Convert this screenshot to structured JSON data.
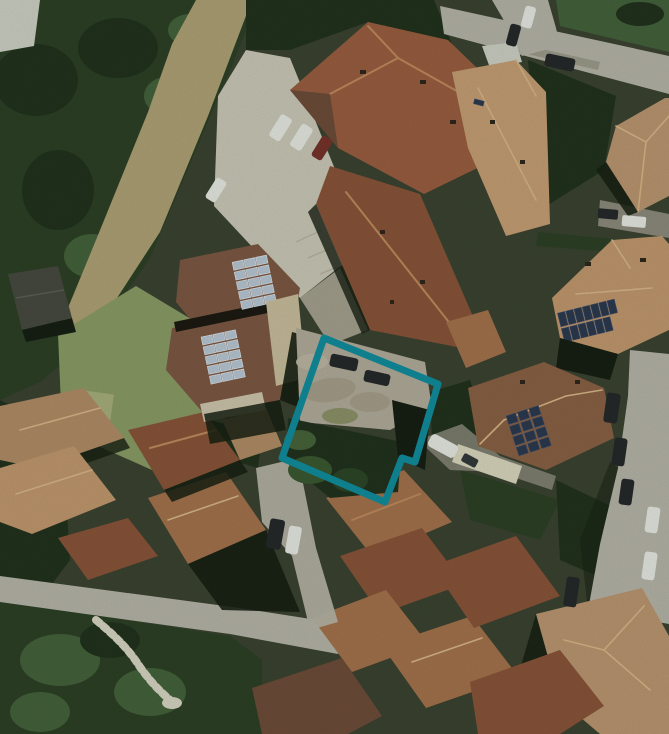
{
  "meta": {
    "view": "satellite-aerial-photograph",
    "description": "Top-down satellite view of a village block with terracotta roofs, gardens, parking areas and a highlighted land parcel",
    "width_px": 669,
    "height_px": 734,
    "no_visible_text": true
  },
  "overlay": {
    "parcel": {
      "name": "highlighted parcel boundary",
      "points": "324,338 438,384 415,462 402,458 385,502 282,458",
      "stroke_width_px": 7,
      "color": "#0f7f8e",
      "shape": "rotated quadrilateral with small step notch on lower-right edge"
    }
  },
  "palette": {
    "base": "#3a4130",
    "tree_dark": "#2c3f24",
    "tree_darker": "#20301c",
    "tree_mid": "#44603a",
    "grass_dry": "#b0a176",
    "grass_lawn": "#8b9b66",
    "lawn_light": "#a8ae7d",
    "pale_patch": "#cfd0c6",
    "paving_light": "#ccc8b8",
    "gravel": "#b3ab9b",
    "road": "#b7b4a9",
    "road_dark": "#8d8a7c",
    "roof_terracotta": "#9a5c40",
    "roof_brown": "#8a5338",
    "roof_brown2": "#7d5743",
    "roof_light_tan": "#c79e74",
    "roof_tan": "#c2976e",
    "roof_salmon": "#bb9570",
    "roof_mid": "#a5714c",
    "roof_pale": "#b28c66",
    "roof_dark": "#6e4a38",
    "ridge": "#c08a5f",
    "ridge_light": "#d9b688",
    "chimney": "#2e241c",
    "shadow": "#161d12",
    "solar_dark": "#2b3750",
    "solar_light": "#b9c7d6",
    "car_white": "#e8e8e4",
    "car_dark": "#24262a",
    "car_red": "#77312a",
    "path_white": "#d9d5c4",
    "terrace": "#cabc9c",
    "parcel_teal": "#0f7f8e"
  },
  "scene": {
    "features": [
      {
        "name": "parcel-boundary-overlay",
        "label": "teal outlined land parcel around a gravel yard with trees"
      },
      {
        "name": "courtyard-gravel",
        "label": "gravel courtyard inside parcel with two dark parked cars"
      },
      {
        "name": "parking-lot",
        "label": "concrete parking area with two silver cars, one dark red car and one white car"
      },
      {
        "name": "main-building-complex",
        "label": "large multi-wing terracotta-roof building complex"
      },
      {
        "name": "solar-house-west",
        "label": "duplex house with two light-blue rooftop solar arrays"
      },
      {
        "name": "solar-house-south",
        "label": "hip-roof house with dark rooftop solar array and white pergola"
      },
      {
        "name": "solar-house-east",
        "label": "hip-roof house with dark rooftop solar array near right edge"
      },
      {
        "name": "top-road",
        "label": "diagonal road along the top-right with a dark car"
      },
      {
        "name": "right-road",
        "label": "street along right edge with parked dark and white cars"
      },
      {
        "name": "bottom-road",
        "label": "village street crossing the lower third"
      },
      {
        "name": "street-spur",
        "label": "narrow lane from courtyard down to the village street with two parked cars"
      },
      {
        "name": "staircase-path",
        "label": "winding white stair footpath through lower-left gardens"
      },
      {
        "name": "tree-grove-upper-left",
        "label": "dense dark tree grove"
      },
      {
        "name": "dry-grass-strip",
        "label": "diagonal strip of dry tan grass"
      },
      {
        "name": "lawn",
        "label": "light green lawn"
      },
      {
        "name": "shed",
        "label": "small dark shed on left edge"
      },
      {
        "name": "village-roofs",
        "label": "cluster of terracotta village roofs in lower half"
      }
    ]
  }
}
